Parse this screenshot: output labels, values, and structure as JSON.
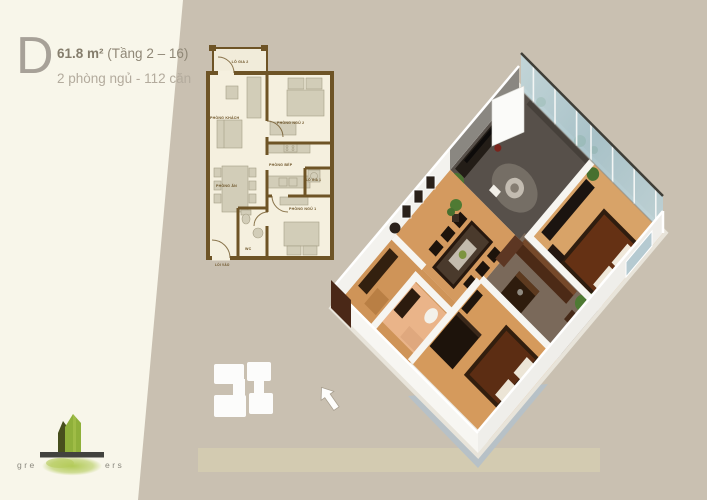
{
  "page": {
    "background": "#c9c0b1",
    "panel": "#f8f6ea"
  },
  "header": {
    "type_letter": "D",
    "area": "61.8 m²",
    "floor_range": "(Tầng 2 – 16)",
    "summary": "2 phòng ngủ - 112 căn"
  },
  "floorplan_2d": {
    "labels": {
      "balcony2": "LÔ GIA 2",
      "living": "PHÒNG KHÁCH",
      "bedroom2": "PHÒNG NGỦ 2",
      "kitchen": "PHÒNG BẾP",
      "balcony1": "LÔ GIA 1",
      "dining": "PHÒNG ĂN",
      "bedroom1": "PHÒNG NGỦ 1",
      "wc": "WC",
      "entrance": "LỐI VÀO"
    },
    "colors": {
      "wall": "#6e5426",
      "room": "#f5f0df",
      "furniture": "#d2cdb8"
    }
  },
  "render_3d": {
    "colors": {
      "wall": "#f4f3ee",
      "accent_wall": "#8a8781",
      "floor_living": "#57504a",
      "floor_wood": "#d59a5c",
      "floor_wc": "#eab489",
      "glass": "#aec8d0",
      "furniture_dark": "#241a10",
      "bedding": "#5c2d13",
      "kitchen_cabinet": "#4c2a16",
      "plant": "#4c7431",
      "slab": "#b7c1c7"
    }
  },
  "logo": {
    "text_left": "gre",
    "text_right": "ers",
    "tower_dark": "#474f1d",
    "tower_light": "#8fb03a",
    "blob": "#a9c150",
    "bar": "#42423e"
  }
}
